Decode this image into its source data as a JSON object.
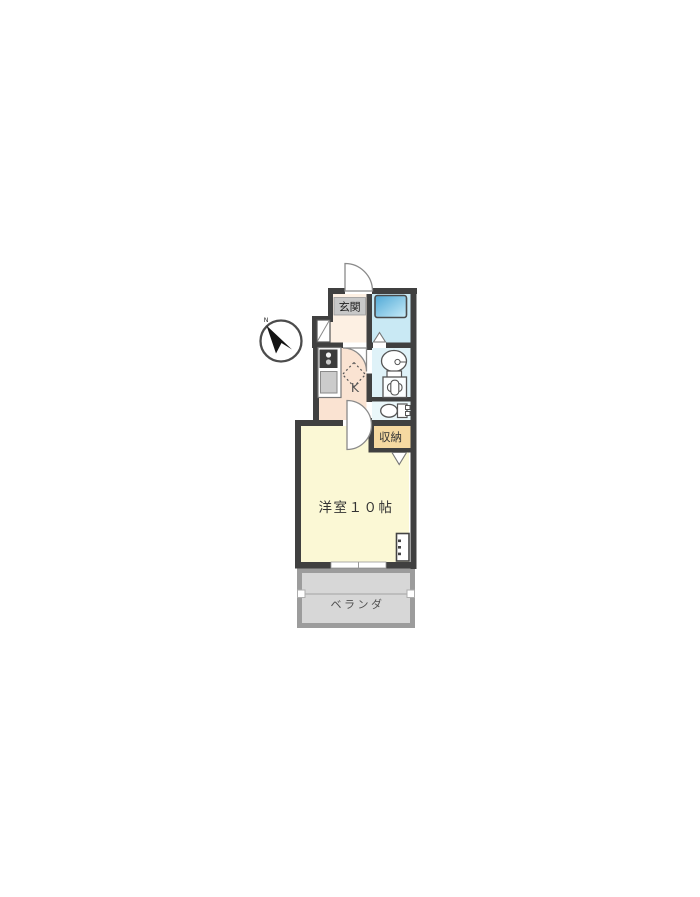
{
  "plan": {
    "compass": {
      "north_label": "N"
    },
    "rooms": {
      "entrance": {
        "label": "玄関"
      },
      "kitchen": {
        "label": "K"
      },
      "storage": {
        "label": "収納"
      },
      "main_room": {
        "label": "洋室１０帖"
      },
      "veranda": {
        "label": "ベランダ"
      }
    },
    "colors": {
      "wall": "#404040",
      "entrance_floor": "#fdf0e3",
      "entrance_label_bg": "#c8c8c8",
      "bathroom_floor": "#c9e9f4",
      "bathtub_dark": "#4fa8d6",
      "bathtub_light": "#c8ecf8",
      "kitchen_floor": "#fae3d2",
      "washroom_floor": "#dff2f8",
      "toilet_floor": "#eaf7fa",
      "storage_floor": "#f6d9a1",
      "main_room_floor": "#fbf8d5",
      "veranda_floor": "#d7d7d7",
      "veranda_wall": "#9c9c9c",
      "door_line": "#8a8a8a",
      "fixture_line": "#555555",
      "stove": "#3b3b3b"
    }
  }
}
